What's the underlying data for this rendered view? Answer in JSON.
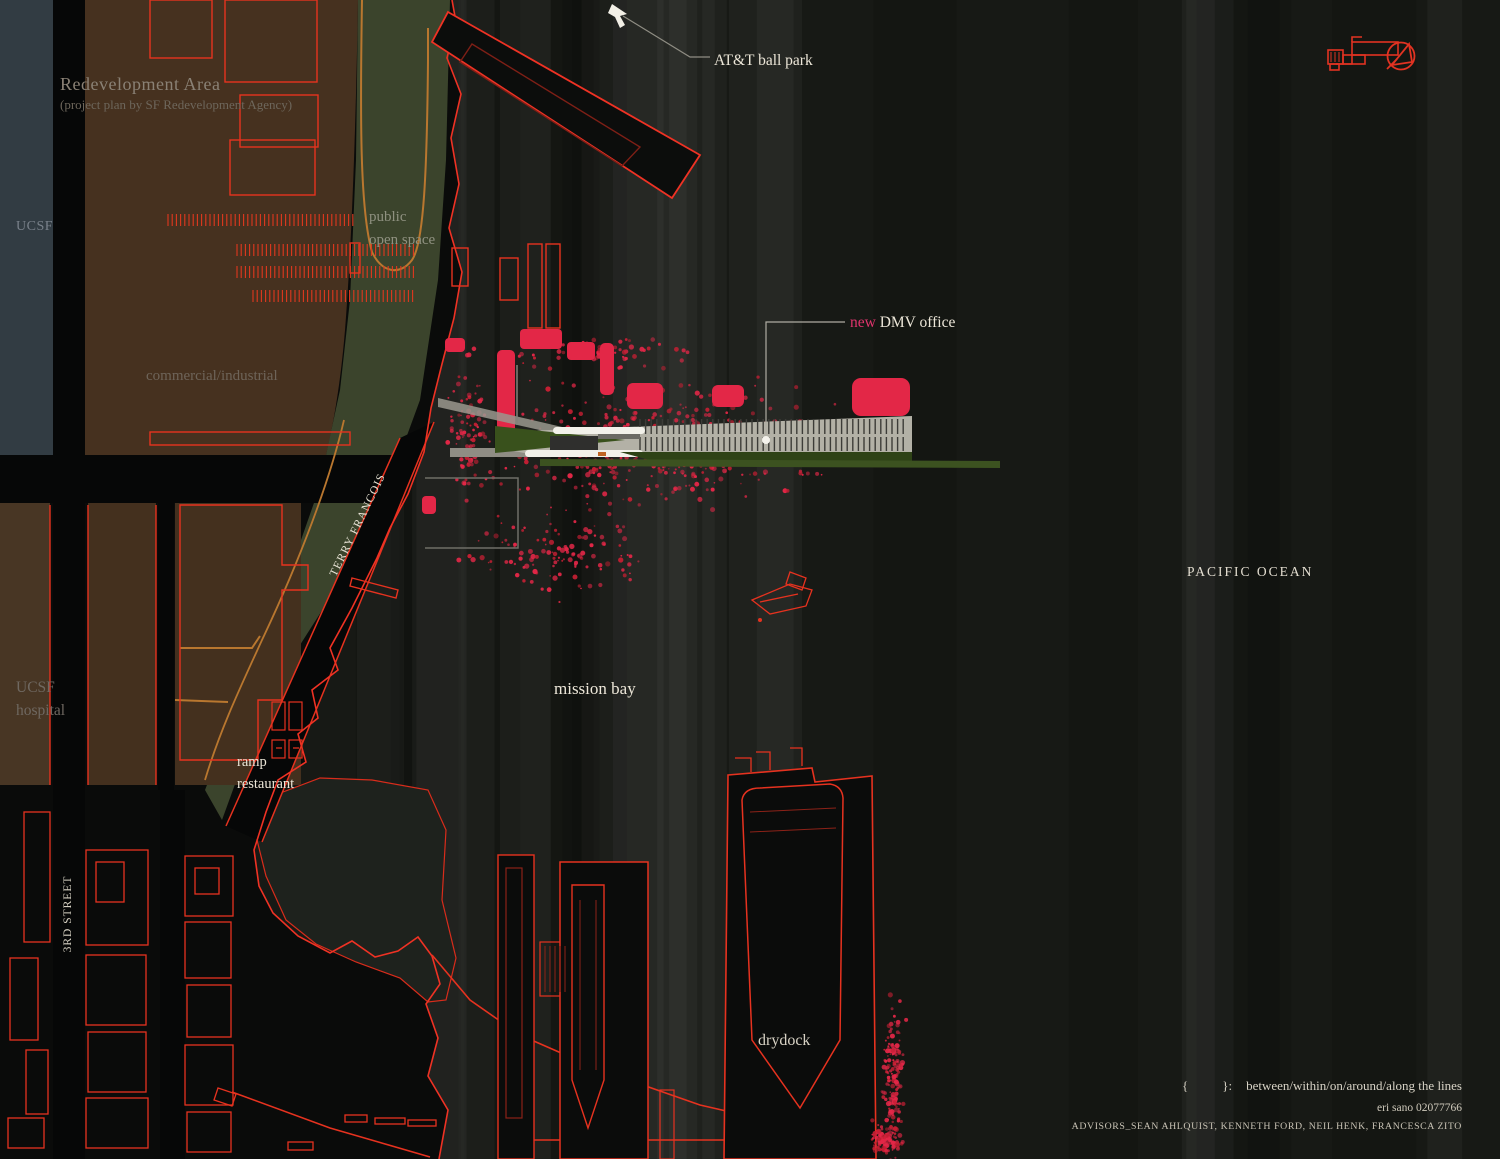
{
  "map": {
    "labels": {
      "redevelopment_area": "Redevelopment Area",
      "redevelopment_area_sub": "(project plan by SF Redevelopment Agency)",
      "ucsf": "UCSF",
      "public_open_space_1": "public",
      "public_open_space_2": "open space",
      "commercial_industrial": "commercial/industrial",
      "att_ball_park": "AT&T ball park",
      "new_dmv_prefix": "new",
      "new_dmv_rest": " DMV office",
      "terry_francois": "TERRY FRANCOIS",
      "ucsf_hospital_1": "UCSF",
      "ucsf_hospital_2": "hospital",
      "ramp_restaurant_1": "ramp",
      "ramp_restaurant_2": "restaurant",
      "mission_bay": "mission bay",
      "pacific_ocean": "PACIFIC OCEAN",
      "third_street": "3RD STREET",
      "drydock": "drydock"
    },
    "icons": {
      "north_arrow": "north-arrow-icon",
      "key_plan": "key-plan-icon",
      "cursor_arrow": "cursor-arrow-icon"
    },
    "colors": {
      "water": "#171915",
      "land": "#0a0b0a",
      "redevelopment_overlay": "#46311f",
      "open_space_green": "#3b442c",
      "ucsf_strip": "#323c43",
      "building_outline_red": "#e6321f",
      "speckle_crimson": "#e32747",
      "road_orange": "#b9772f",
      "plan_gray": "#b3b1a6",
      "label_cream": "#ece6d8",
      "new_pink": "#e0346d"
    }
  },
  "credits": {
    "brace_open": "{",
    "brace_close": "}",
    "colon": ":",
    "legend_text": "between/within/on/around/along the lines",
    "author": "eri sano 02077766",
    "advisors": "ADVISORS_SEAN AHLQUIST, KENNETH FORD, NEIL HENK, FRANCESCA ZITO"
  }
}
